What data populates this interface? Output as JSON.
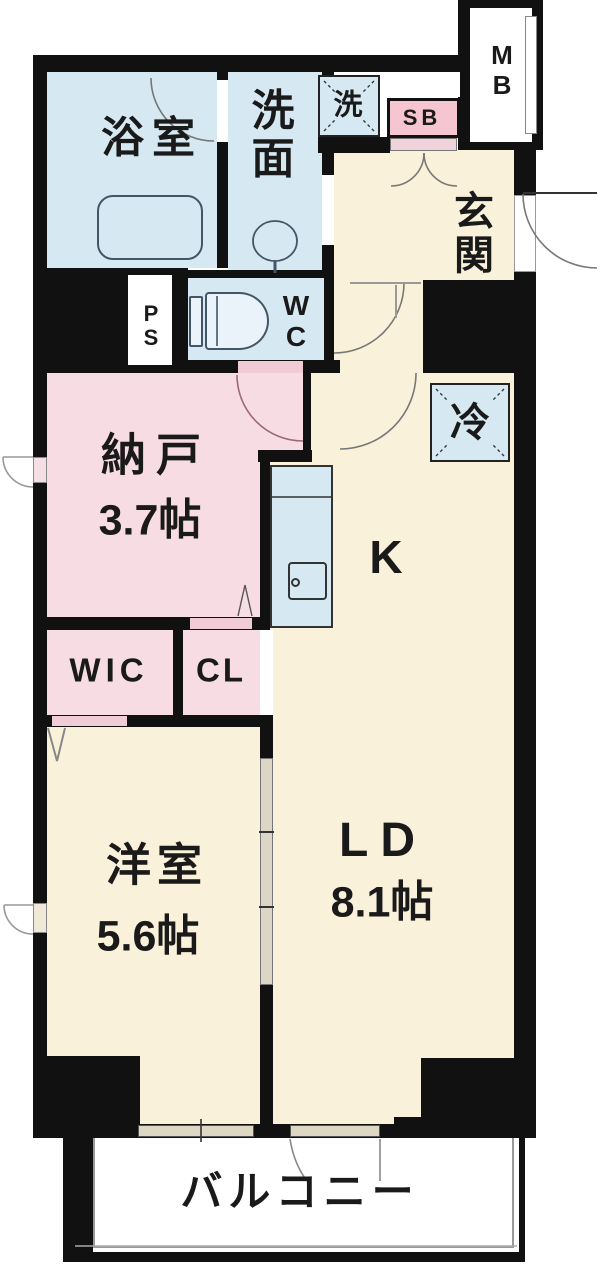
{
  "plan": {
    "title": "間取り図",
    "colors": {
      "water_blue": "#d6e9f2",
      "pink": "#f8dce3",
      "shoe_box_pink": "#f5c6d2",
      "cream": "#faf1da",
      "wall_black": "#111111",
      "door_strip_pink": "#f0cdd6",
      "window_beige": "#ded7c3"
    },
    "rooms": {
      "bathroom": {
        "label": "浴室"
      },
      "washroom": {
        "char1": "洗",
        "char2": "面"
      },
      "washer_space": {
        "label": "洗"
      },
      "toilet": {
        "char1": "W",
        "char2": "C"
      },
      "pipe_space": {
        "char1": "P",
        "char2": "S"
      },
      "meter_box": {
        "char1": "M",
        "char2": "B"
      },
      "shoe_box": {
        "label": "SB"
      },
      "entrance": {
        "char1": "玄",
        "char2": "関"
      },
      "storage_room": {
        "label": "納戸",
        "size": "3.7帖"
      },
      "refrigerator": {
        "label": "冷"
      },
      "kitchen": {
        "label": "K"
      },
      "walk_in_closet": {
        "label": "WIC"
      },
      "closet": {
        "label": "CL"
      },
      "western_room": {
        "label": "洋室",
        "size": "5.6帖"
      },
      "living_dining": {
        "label": "LD",
        "size": "8.1帖"
      },
      "balcony": {
        "label": "バルコニー"
      }
    }
  }
}
